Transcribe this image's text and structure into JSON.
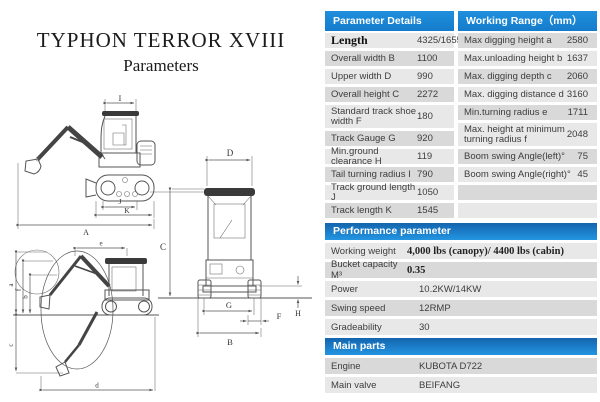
{
  "title": {
    "line1": "TYPHON TERROR XVIII",
    "line2": "Parameters"
  },
  "colors": {
    "header_blue": "#1987d3",
    "section_gradient_top": "#1464ad",
    "section_gradient_bottom": "#2395e2",
    "row_gray": "#d9d9d9",
    "row_light": "#e8e8e8"
  },
  "spec_table": {
    "left_header": "Parameter Details（mm）",
    "right_header": "Working Range（mm）",
    "left_rows": [
      {
        "label": "Length",
        "value": "4325/1655",
        "serif_label": true
      },
      {
        "label": "Overall width B",
        "value": "1100"
      },
      {
        "label": "Upper width D",
        "value": "990"
      },
      {
        "label": "Overall height C",
        "value": "2272"
      },
      {
        "label": "Standard track shoe width F",
        "value": "180",
        "tall": true
      },
      {
        "label": "Track Gauge G",
        "value": "920"
      },
      {
        "label": "Min.ground clearance H",
        "value": "119"
      },
      {
        "label": "Tail turning radius I",
        "value": "790"
      },
      {
        "label": "Track ground length J",
        "value": "1050"
      },
      {
        "label": "Track length K",
        "value": "1545"
      }
    ],
    "right_rows": [
      {
        "label": "Max digging height a",
        "value": "2580"
      },
      {
        "label": "Max.unloading height b",
        "value": "1637"
      },
      {
        "label": "Max. digging depth c",
        "value": "2060"
      },
      {
        "label": "Max. digging distance d",
        "value": "3160"
      },
      {
        "label": "Min.turning radius e",
        "value": "1711"
      },
      {
        "label": "Max. height at minimum turning radius f",
        "value": "2048",
        "tall": true
      },
      {
        "label": "Boom swing Angle(left)°",
        "value": "75"
      },
      {
        "label": "Boom swing Angle(right)°",
        "value": "45"
      },
      {
        "label": "",
        "value": "",
        "empty": true
      },
      {
        "label": "",
        "value": "",
        "empty": true
      }
    ]
  },
  "performance": {
    "header": "Performance parameter",
    "rows": [
      {
        "label": "Working weight",
        "value": "4,000 lbs (canopy)/ 4400 lbs (cabin)",
        "serif_value": true
      },
      {
        "label": "Bucket capacity M³",
        "value": "0.35",
        "serif_value": true
      },
      {
        "label": "Power",
        "value": "10.2KW/14KW"
      },
      {
        "label": "Swing speed",
        "value": "12RMP"
      },
      {
        "label": "Gradeability",
        "value": "30"
      }
    ]
  },
  "main_parts": {
    "header": "Main parts",
    "rows": [
      {
        "label": "Engine",
        "value": "KUBOTA D722"
      },
      {
        "label": "Main valve",
        "value": "BEIFANG"
      }
    ]
  },
  "diagrams": {
    "side_view": {
      "cab_width": "I",
      "track_ground_length": "J",
      "track_length": "K",
      "overall_length": "A"
    },
    "front_view": {
      "upper_width": "D",
      "overall_height": "C",
      "track_gauge": "G",
      "shoe_width": "F",
      "overall_width": "B",
      "ground_clearance": "H"
    },
    "working_range": {
      "turning_radius": "e",
      "digging_height": "a",
      "min_turn_height": "f",
      "unloading_height": "b",
      "digging_depth": "c",
      "digging_distance": "d"
    }
  }
}
